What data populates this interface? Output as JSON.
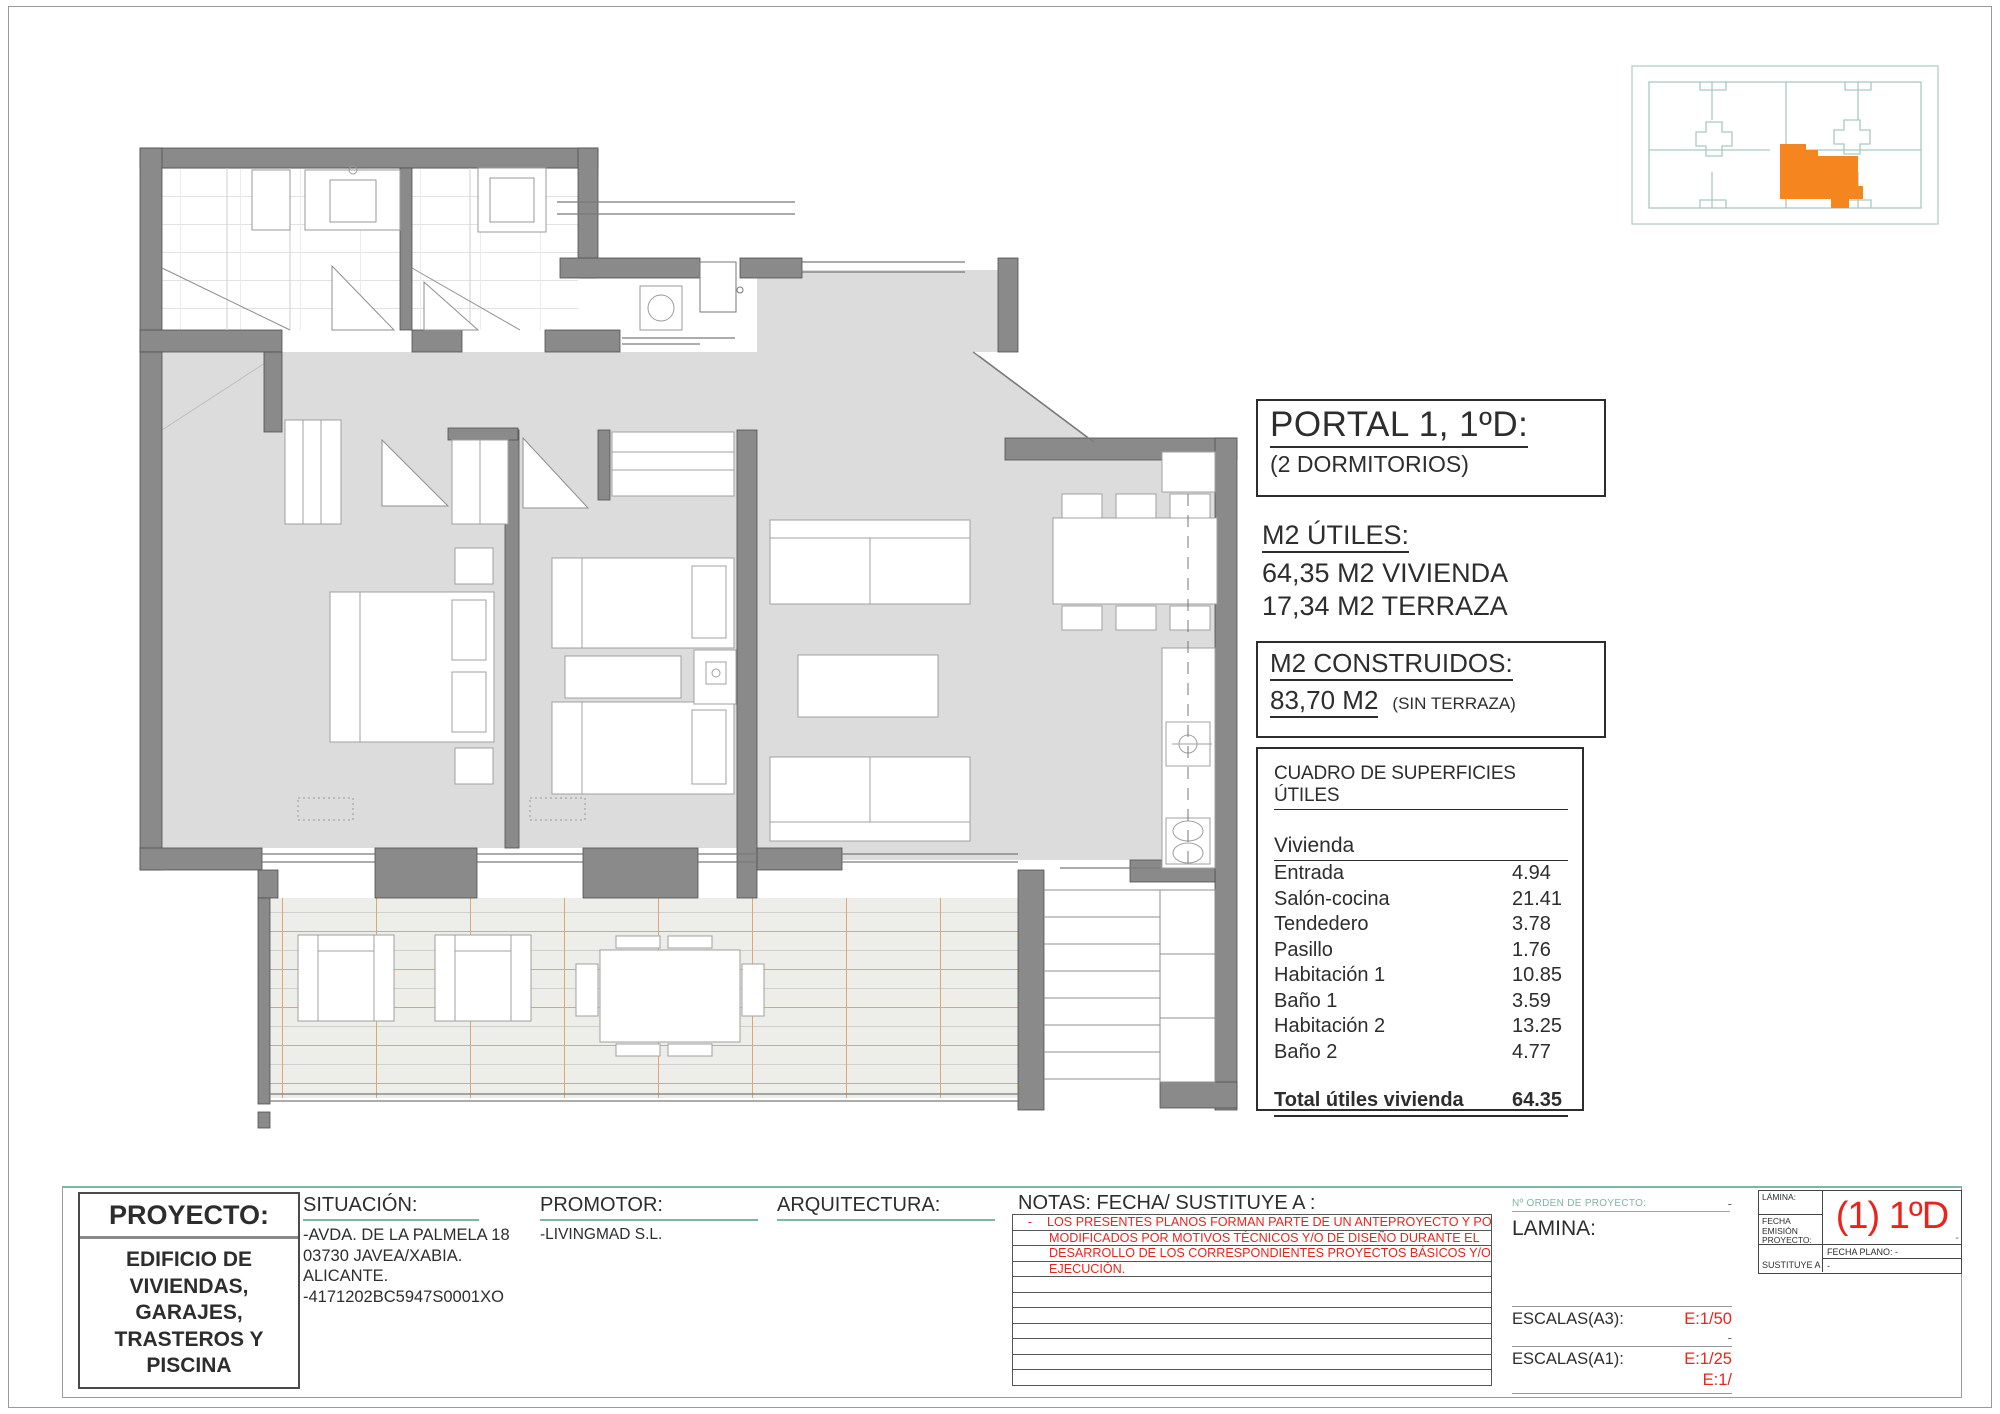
{
  "colors": {
    "accent_red": "#e8251d",
    "teal_line": "#7eb5a4",
    "keyplan_teal": "#a9cabf",
    "unit_orange": "#f5861f",
    "wall_gray": "#8a8a8a"
  },
  "portal": {
    "title": "PORTAL 1, 1ºD:",
    "subtitle": "(2 DORMITORIOS)"
  },
  "utiles": {
    "heading": "M2 ÚTILES:",
    "line1": "64,35 M2 VIVIENDA",
    "line2": "17,34 M2 TERRAZA"
  },
  "construidos": {
    "heading": "M2 CONSTRUIDOS:",
    "value": "83,70 M2",
    "note": "(SIN TERRAZA)"
  },
  "cuadro": {
    "title": "CUADRO DE SUPERFICIES ÚTILES",
    "group": "Vivienda",
    "rows": [
      {
        "label": "Entrada",
        "value": "4.94"
      },
      {
        "label": "Salón-cocina",
        "value": "21.41"
      },
      {
        "label": "Tendedero",
        "value": "3.78"
      },
      {
        "label": "Pasillo",
        "value": "1.76"
      },
      {
        "label": "Habitación 1",
        "value": "10.85"
      },
      {
        "label": "Baño 1",
        "value": "3.59"
      },
      {
        "label": "Habitación 2",
        "value": "13.25"
      },
      {
        "label": "Baño 2",
        "value": "4.77"
      }
    ],
    "total_label": "Total útiles vivienda",
    "total_value": "64.35"
  },
  "titleblock": {
    "proyecto_label": "PROYECTO:",
    "proyecto_lines": [
      "EDIFICIO DE",
      "VIVIENDAS,",
      "GARAJES,",
      "TRASTEROS Y",
      "PISCINA"
    ],
    "situacion_label": "SITUACIÓN:",
    "situacion_lines": [
      "-AVDA. DE LA PALMELA 18",
      "03730 JAVEA/XABIA. ALICANTE.",
      "-4171202BC5947S0001XO"
    ],
    "promotor_label": "PROMOTOR:",
    "promotor_value": "-LIVINGMAD S.L.",
    "arquitectura_label": "ARQUITECTURA:",
    "notas_label": "NOTAS: FECHA/ SUSTITUYE A :",
    "notas_dash": "-",
    "notas_lines": [
      "LOS PRESENTES PLANOS FORMAN PARTE DE UN ANTEPROYECTO Y PODRÁN SER",
      "MODIFICADOS  POR MOTIVOS TÉCNICOS Y/O DE DISEÑO DURANTE EL",
      "DESARROLLO DE LOS CORRESPONDIENTES PROYECTOS BÁSICOS Y/O DE",
      "EJECUCIÓN."
    ],
    "orden_label": "Nº ORDEN DE PROYECTO:",
    "orden_value": "-",
    "lamina_label": "LAMINA:",
    "escalas_a3_label": "ESCALAS(A3):",
    "escalas_a3_value": "E:1/50",
    "escalas_dash": "-",
    "escalas_a1_label": "ESCALAS(A1):",
    "escalas_a1_value": "E:1/25",
    "escalas_a1_value2": "E:1/"
  },
  "stamp": {
    "lamina_label": "LÁMINA:",
    "code": "(1) 1ºD",
    "code_dash": "-",
    "fecha_emision_label": "FECHA EMISIÓN PROYECTO:",
    "fecha_plano_label": "FECHA PLANO:  -",
    "sustituye_label": "SUSTITUYE A",
    "sustituye_value": "-"
  }
}
